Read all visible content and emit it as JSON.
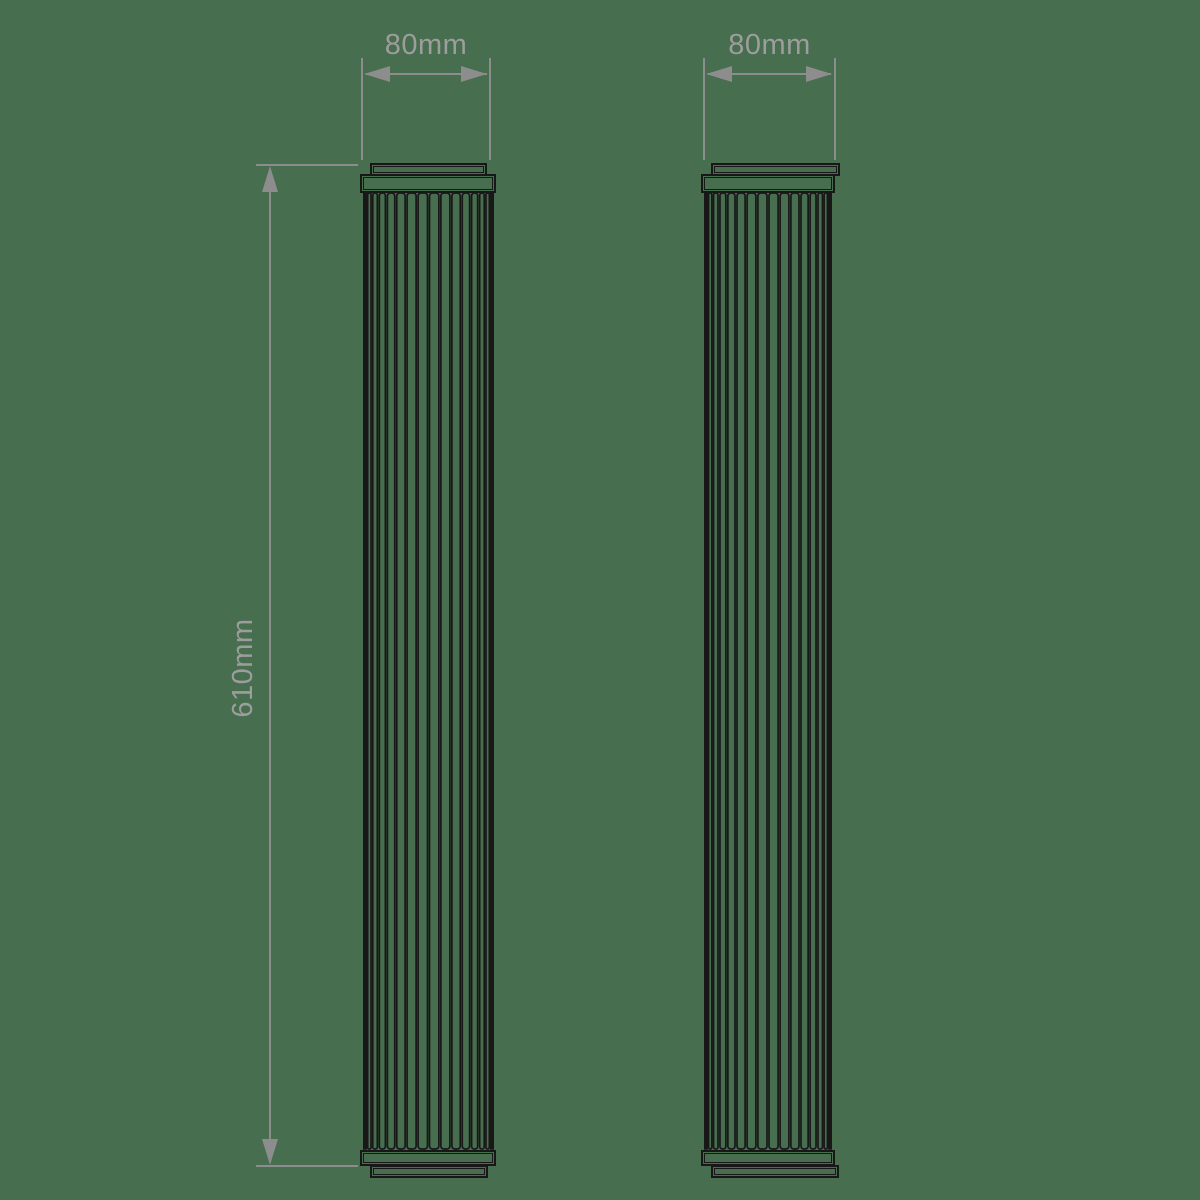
{
  "drawing": {
    "type": "technical-dimension-drawing",
    "background": "#476e4e",
    "line_color": "#181818",
    "dim_color": "#8d8d8d",
    "text_color": "#9d9d9d",
    "flute_count": 18,
    "height_label": "610mm",
    "views": [
      {
        "name": "left-elevation",
        "width_label": "80mm"
      },
      {
        "name": "right-elevation",
        "width_label": "80mm"
      }
    ]
  }
}
